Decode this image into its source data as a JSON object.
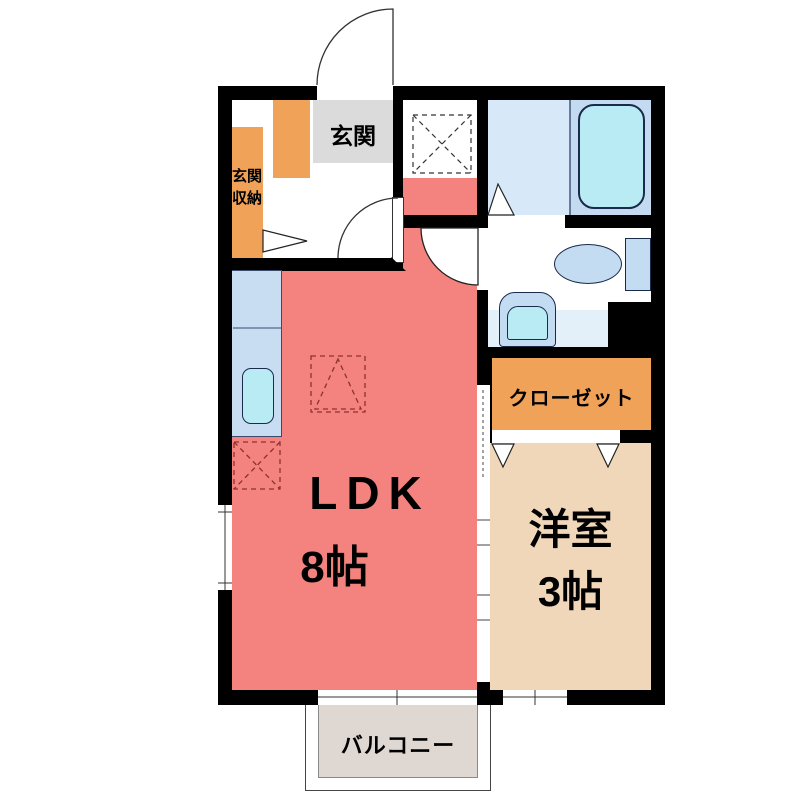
{
  "rooms": {
    "genkan": {
      "label": "玄関"
    },
    "genkan_storage": {
      "label_line1": "玄関",
      "label_line2": "収納"
    },
    "closet": {
      "label": "クローゼット"
    },
    "ldk": {
      "label": "LDK",
      "size": "8帖"
    },
    "western_room": {
      "label": "洋室",
      "size": "3帖"
    },
    "balcony": {
      "label": "バルコニー"
    }
  },
  "fixtures": {
    "bathtub": "bathtub-icon",
    "toilet": "toilet-icon",
    "washbasin": "washbasin-icon",
    "kitchen_sink": "kitchen-sink-icon",
    "washing_machine_space": "washing-machine-space-marker",
    "refrigerator_space": "refrigerator-space-marker",
    "stove_space": "stove-space-marker"
  },
  "colors": {
    "wall": "#000000",
    "ldk": "#F4837F",
    "western_room": "#F1D7B9",
    "orange": "#EFA258",
    "genkan_gray": "#DBDBDB",
    "counter_blue": "#C8DCF2",
    "fixture_blue": "#C3DCF2",
    "fixture_cyan": "#B9EBF5",
    "bath_floor": "#D7E9F8",
    "tub_zone": "#C4DAF1",
    "washroom_strip": "#E3EFF9",
    "balcony_gray": "#DFD8D2",
    "marker_red": "#8A3230"
  }
}
